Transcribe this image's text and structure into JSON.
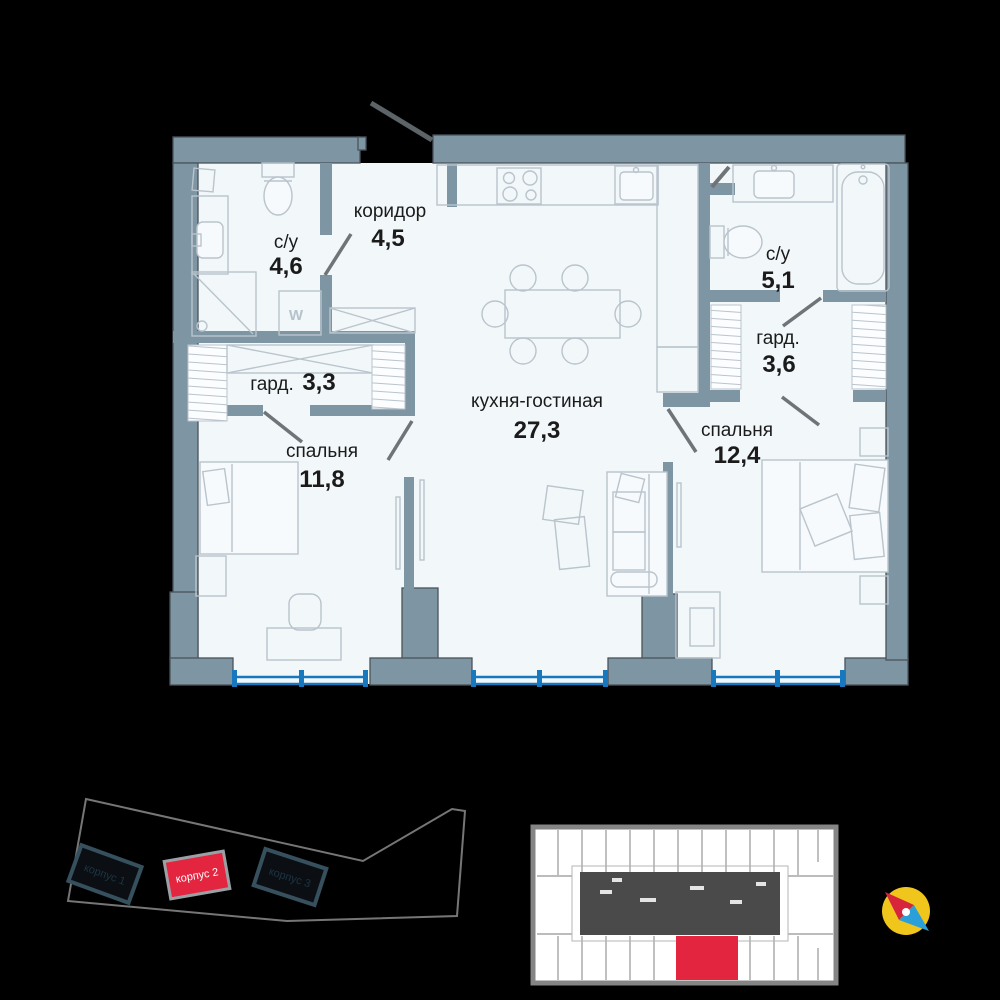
{
  "floor_plan": {
    "rooms": [
      {
        "id": "bathroom-1",
        "name": "с/у",
        "area": "4,6"
      },
      {
        "id": "corridor",
        "name": "коридор",
        "area": "4,5"
      },
      {
        "id": "wardrobe-1",
        "name": "гард.",
        "area": "3,3"
      },
      {
        "id": "bedroom-1",
        "name": "спальня",
        "area": "11,8"
      },
      {
        "id": "kitchen-living",
        "name": "кухня-гостиная",
        "area": "27,3"
      },
      {
        "id": "bathroom-2",
        "name": "с/у",
        "area": "5,1"
      },
      {
        "id": "wardrobe-2",
        "name": "гард.",
        "area": "3,6"
      },
      {
        "id": "bedroom-2",
        "name": "спальня",
        "area": "12,4"
      }
    ],
    "washer_label": "W"
  },
  "site_plan": {
    "buildings": [
      {
        "label": "корпус 1",
        "highlighted": false
      },
      {
        "label": "корпус 2",
        "highlighted": true
      },
      {
        "label": "корпус 3",
        "highlighted": false
      }
    ]
  },
  "colors": {
    "wall": "#7e95a3",
    "floor": "#f2f7fa",
    "outline": "#4a545c",
    "furniture_line": "#b9c4cc",
    "window_blue": "#1878be",
    "accent_red": "#e32540",
    "compass_yellow": "#f0c51c",
    "compass_blue": "#2a9fd8",
    "compass_red": "#d7263c",
    "building_dark": "#0b0f14",
    "building_border": "#36505e",
    "building_label_dark": "#1d3442",
    "overview_core": "#4a4a4a"
  }
}
